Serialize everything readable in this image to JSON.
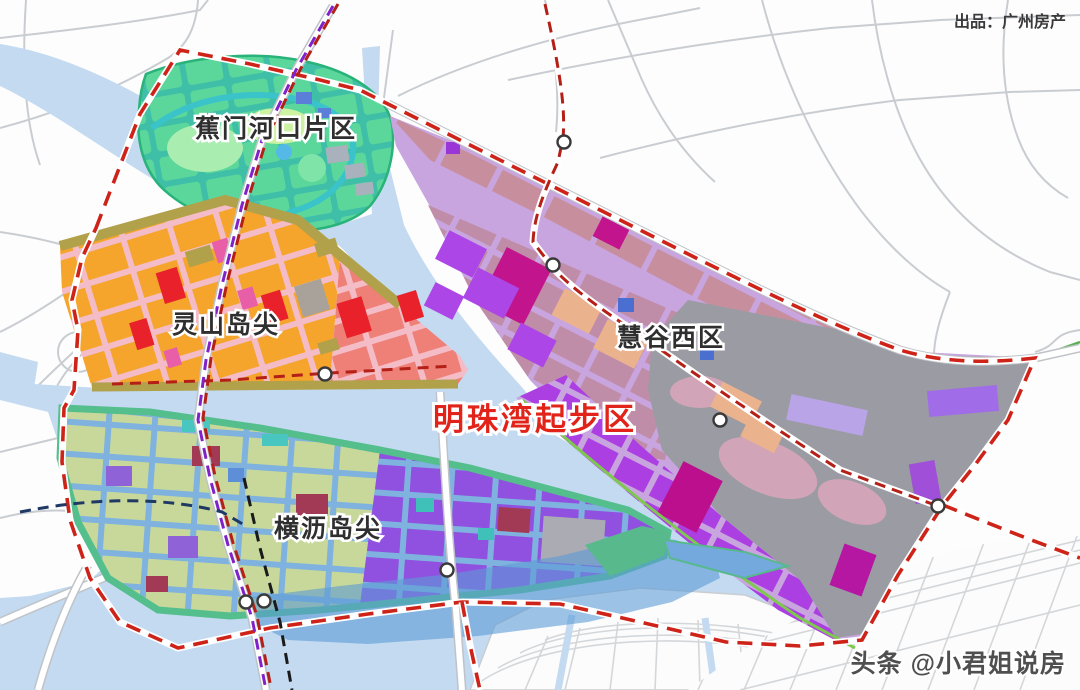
{
  "page": {
    "credit": "出品：广州房产",
    "watermark": "头条 @小君姐说房"
  },
  "map": {
    "center_label": "明珠湾起步区",
    "regions": [
      {
        "id": "jiaomen",
        "name": "蕉门河口片区",
        "color": "#4ed492"
      },
      {
        "id": "lingshan",
        "name": "灵山岛尖",
        "color": "#f5a42c"
      },
      {
        "id": "huigu",
        "name": "慧谷西区",
        "color": "#c8a5de"
      },
      {
        "id": "hengli",
        "name": "横沥岛尖",
        "color": "#c7d89a"
      }
    ],
    "colors": {
      "water": "#c3daf1",
      "center_label": "#e2231a",
      "boundary": "#ce2318",
      "metro_purple": "#8022c8",
      "metro_red": "#b42018",
      "metro_black": "#1a1a1a",
      "metro_navy": "#1f3864",
      "label_text": "#2f2f2f",
      "credit_text": "#3a3a3a",
      "watermark_text": "#4f4f4f"
    }
  }
}
